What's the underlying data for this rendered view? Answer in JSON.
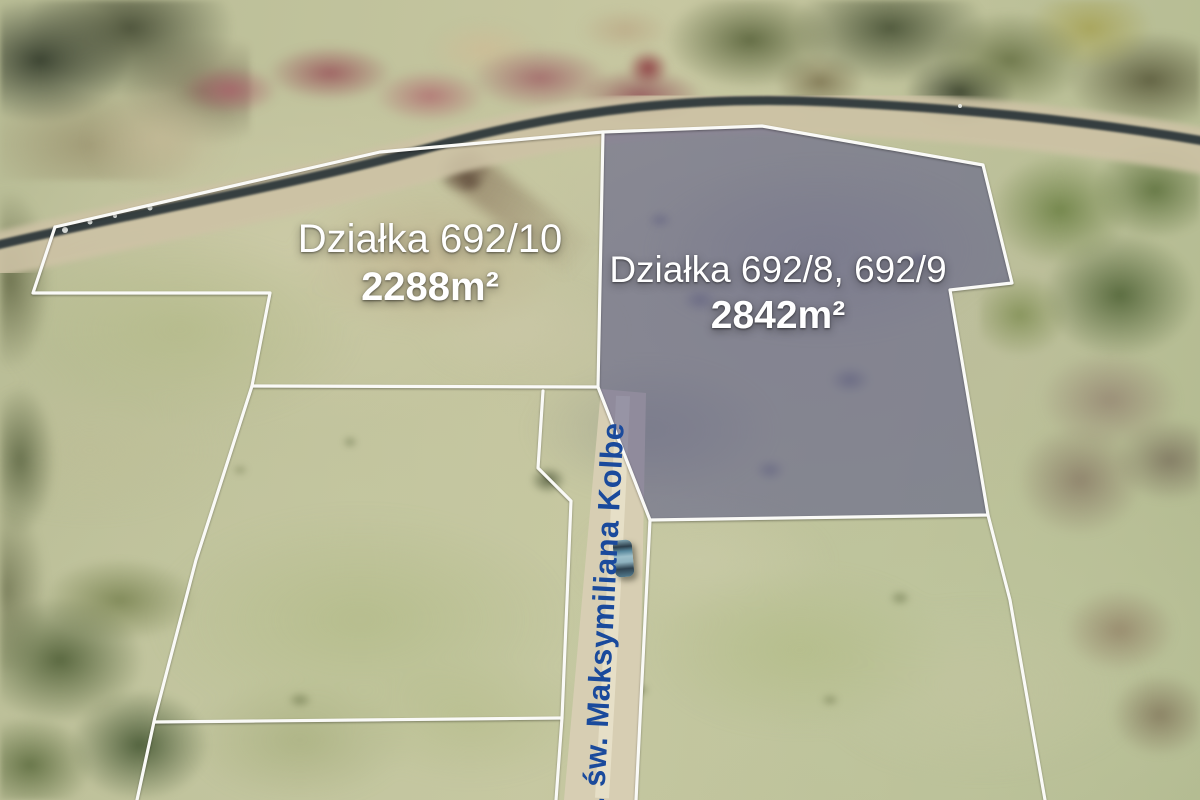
{
  "scene": {
    "kind": "aerial drone photo of grassland building plots",
    "features": [
      "stream with spring brush along the top",
      "white surveyed boundary lines",
      "dirt road with a parked car",
      "highlighted plot with violet overlay"
    ]
  },
  "plots": [
    {
      "name": "Działka 692/10",
      "area": "2288m²",
      "highlighted": false
    },
    {
      "name": "Działka 692/8, 692/9",
      "area": "2842m²",
      "highlighted": true
    }
  ],
  "road": {
    "name": "ul. św. Maksymiliana Kolbe"
  },
  "colors": {
    "boundary_line": "#fafaf7",
    "highlight_overlay": "rgba(78,78,135,0.52)",
    "plot_label_text": "#ffffff",
    "road_label_text": "#1a4a9c"
  }
}
